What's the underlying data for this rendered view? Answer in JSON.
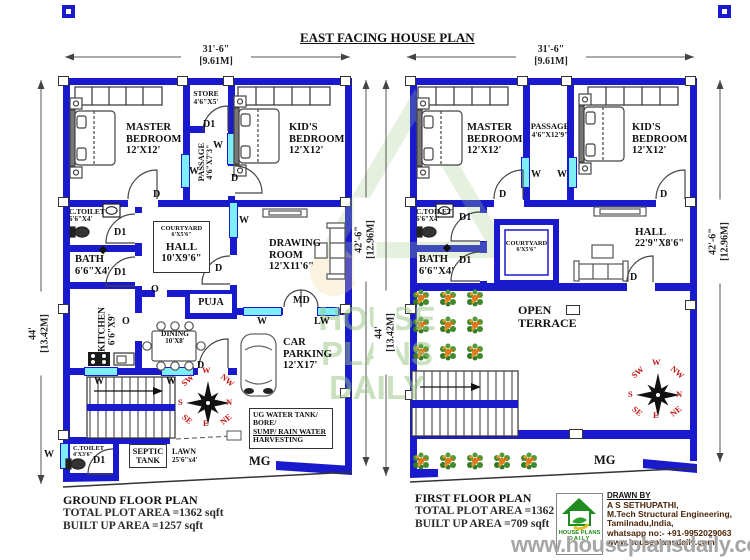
{
  "title": "EAST FACING HOUSE PLAN",
  "dims": {
    "width_ft": "31'-6\"",
    "width_m": "[9.61M]",
    "left_ft": "44'",
    "left_m": "[13.42M]",
    "right_ft": "42'-6\"",
    "right_m": "[12.96M]"
  },
  "markers": {
    "d": "D",
    "d1": "D1",
    "w": "W",
    "o": "O",
    "md": "MD",
    "lw": "LW"
  },
  "compass": {
    "n": "N",
    "s": "S",
    "e": "E",
    "w": "W",
    "ne": "NE",
    "nw": "NW",
    "se": "SE",
    "sw": "SW"
  },
  "ground": {
    "rooms": {
      "master": {
        "l1": "MASTER",
        "l2": "BEDROOM",
        "size": "12'X12'"
      },
      "store": {
        "name": "STORE",
        "size": "4'6\"X5'"
      },
      "kids": {
        "l1": "KID'S",
        "l2": "BEDROOM",
        "size": "12'X12'"
      },
      "passage": {
        "name": "PASSAGE",
        "size": "4'6\"X7'3\""
      },
      "ctoilet": {
        "name": "C.TOILET",
        "size": "6'6\"X4'"
      },
      "bath": {
        "name": "BATH",
        "size": "6'6\"X4'"
      },
      "kitchen": {
        "name": "KITCHEN",
        "size": "6'6\"X9'"
      },
      "courtyard": {
        "name": "COURTYARD",
        "size": "6'X5'6\""
      },
      "hall": {
        "name": "HALL",
        "size": "10'X9'6\""
      },
      "drawing": {
        "l1": "DRAWING",
        "l2": "ROOM",
        "size": "12'X11'6\""
      },
      "puja": {
        "name": "PUJA"
      },
      "dining": {
        "name": "DINING",
        "size": "10'X8'"
      },
      "car": {
        "l1": "CAR",
        "l2": "PARKING",
        "size": "12'X17'"
      },
      "ctoilet2": {
        "name": "C.TOILET",
        "size": "4'X3'6\""
      },
      "septic": {
        "l1": "SEPTIC",
        "l2": "TANK"
      },
      "lawn": {
        "name": "LAWN",
        "size": "25'6\"x4'"
      },
      "ug": {
        "l1": "UG WATER TANK/",
        "l2": "BORE/",
        "l3": "SUMP/ RAIN WATER",
        "l4": "HARVESTING"
      },
      "mg": "MG"
    },
    "footer": {
      "title": "GROUND FLOOR PLAN",
      "plot": "TOTAL PLOT AREA =1362 sqft",
      "built": "BUILT UP AREA =1257 sqft"
    }
  },
  "first": {
    "rooms": {
      "master": {
        "l1": "MASTER",
        "l2": "BEDROOM",
        "size": "12'X12'"
      },
      "passage": {
        "name": "PASSAGE",
        "size": "4'6\"X12'9\""
      },
      "kids": {
        "l1": "KID'S",
        "l2": "BEDROOM",
        "size": "12'X12'"
      },
      "ctoilet": {
        "name": "C.TOILET",
        "size": "6'6\"X4'"
      },
      "bath": {
        "name": "BATH",
        "size": "6'6\"X4'"
      },
      "courtyard": {
        "name": "COURTYARD",
        "size": "6'X5'6\""
      },
      "hall": {
        "name": "HALL",
        "size": "22'9\"X8'6\""
      },
      "terrace": {
        "l1": "OPEN",
        "l2": "TERRACE"
      },
      "mg": "MG"
    },
    "footer": {
      "title": "FIRST FLOOR PLAN",
      "plot": "TOTAL PLOT AREA =1362 sqft",
      "built": "BUILT UP AREA =709 sqft"
    }
  },
  "credits": {
    "drawn_by": "DRAWN BY",
    "name": "A S SETHUPATHI,",
    "degree": "M.Tech Structural Engineering,",
    "place": "Tamilnadu,India,",
    "phone": "whatsapp no:- +91-9952029063",
    "site": "www.houseplansdaily.com"
  },
  "logo": {
    "l1": "HOUSE PLANS",
    "l2": "DAILY"
  },
  "watermarks": {
    "bottom": "www.houseplansdaily.com",
    "center_l1": "HOUSE PLANS",
    "center_l2": "DAILY"
  },
  "colors": {
    "wall": "#1a1acd",
    "window": "#7deef5",
    "compass_red": "#c41414",
    "logo_green": "#1e8c1e"
  }
}
